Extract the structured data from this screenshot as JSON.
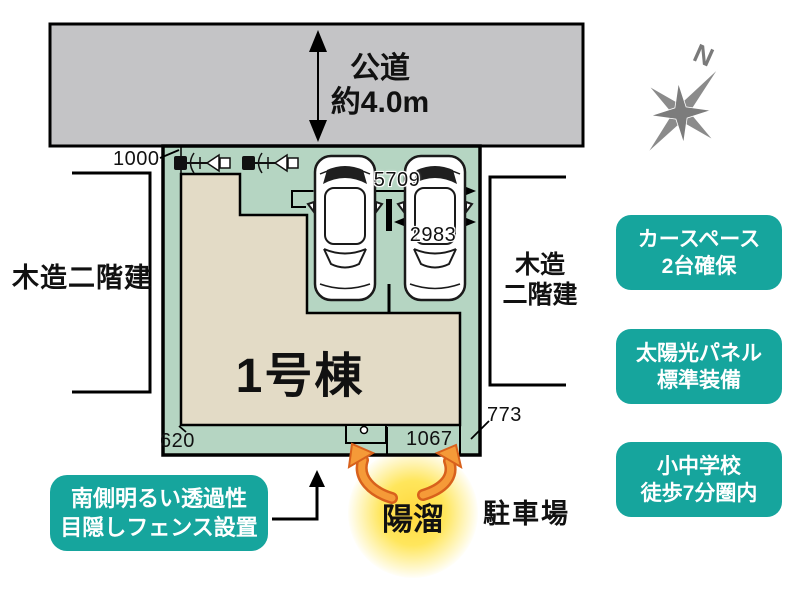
{
  "road": {
    "name": "公道",
    "width_label": "約4.0m"
  },
  "compass": {
    "north_label": "N"
  },
  "site": {
    "building_label": "1号棟",
    "dimensions": {
      "front_setback": "1000",
      "parking_total_width": "5709",
      "parking_inner_width": "2983",
      "side_left": "620",
      "bottom_strip": "1067",
      "corner": "773"
    }
  },
  "neighbors": {
    "left_label": "木造二階建",
    "right_label_line1": "木造",
    "right_label_line2": "二階建"
  },
  "feature_badges": [
    {
      "line1": "カースペース",
      "line2": "2台確保"
    },
    {
      "line1": "太陽光パネル",
      "line2": "標準装備"
    },
    {
      "line1": "小中学校",
      "line2": "徒歩7分圏内"
    }
  ],
  "fence_badge": {
    "line1": "南側明るい透過性",
    "line2": "目隠しフェンス設置"
  },
  "sun_label": "陽溜",
  "parking_lot_label": "駐車場",
  "colors": {
    "road_gray": "#c4c4c6",
    "plot_green": "#b5d5c2",
    "building_beige": "#e3dbc6",
    "badge_teal": "#16a59d",
    "sun_orange": "#f59a38",
    "sun_glow_yellow": "#ffd83e"
  }
}
